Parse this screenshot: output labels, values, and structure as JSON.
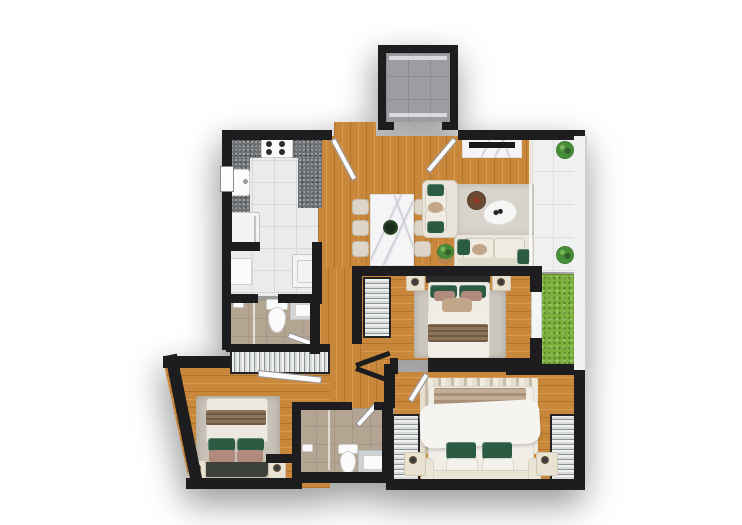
{
  "scene": {
    "title": "apartment-floor-plan",
    "view": "3d-top-down-render",
    "background": "#ffffff"
  },
  "colors": {
    "wall": "#1d1d1f",
    "wood": "#c8873a",
    "woodLight": "#d89b4f",
    "woodDark": "#b0742d",
    "tile": "#e9ebec",
    "tileLine": "#d6d8da",
    "tan": "#b4a593",
    "tanLine": "#a59686",
    "balc": "#eef0f1",
    "balcLine": "#dde0e2",
    "elev": "#9b9da0",
    "elevLine": "#8a8c8f",
    "grass": "#7eb13d",
    "grassDark": "#5f9030",
    "granite": "#6e7173",
    "appl": "#f4f4f5",
    "applEdge": "#c6c6c8",
    "fix": "#fbfbfc",
    "fixEdge": "#cfcfd1",
    "stripeB": "#8e9496",
    "frame": "#242426",
    "sofa": "#eae5da",
    "sofaEdge": "#d2cabb",
    "green": "#2b5c43",
    "tanPillow": "#c2a689",
    "pink": "#b08a7c",
    "throw": "#8d7459",
    "throwLine": "#6f5a43",
    "rugLiving": "#d8d4cc",
    "rugBed3": "#cdc7bf",
    "rugBed2": "#c8c1b7",
    "rugMA": "#e6dfd1",
    "rugMB": "#c8bda9",
    "marble": "#f5f5f7",
    "vein": "#c9cad0",
    "hbDark": "#2b2b2d",
    "hbCream": "#ebe5d8",
    "leaf": "#fcfcfc",
    "leafEdge": "#8a8a8c",
    "outerW": "#f0f1f2",
    "outerWEdge": "#cdd0d2",
    "stool": "#b5864f",
    "brownTable": "#6b4a33",
    "mug": "#8a3b2a"
  },
  "rooms": [
    {
      "name": "elevator"
    },
    {
      "name": "kitchen"
    },
    {
      "name": "laundry"
    },
    {
      "name": "bathroom-1"
    },
    {
      "name": "hall-closet"
    },
    {
      "name": "living-dining"
    },
    {
      "name": "balcony"
    },
    {
      "name": "planter-grass"
    },
    {
      "name": "bedroom-1"
    },
    {
      "name": "hallway"
    },
    {
      "name": "bedroom-2"
    },
    {
      "name": "bathroom-2"
    },
    {
      "name": "master-bedroom"
    }
  ],
  "furniture": {
    "kitchen": [
      "granite-counter",
      "stove-4-burner",
      "sink",
      "refrigerator"
    ],
    "laundry": [
      "utility-sink",
      "washing-machine"
    ],
    "bathroom_1": [
      "toilet",
      "vanity-sink",
      "shower"
    ],
    "living_dining": [
      "dining-table-marble",
      "dining-chairs-x6",
      "loveseat",
      "sofa",
      "area-rug",
      "coffee-table",
      "round-side-table",
      "potted-plant",
      "tv-console"
    ],
    "balcony": [
      "potted-plant",
      "potted-plant"
    ],
    "bedroom_1": [
      "double-bed",
      "nightstand-x2",
      "wardrobe",
      "area-rug"
    ],
    "bedroom_2": [
      "double-bed",
      "nightstand-x2",
      "area-rug"
    ],
    "bathroom_2": [
      "toilet",
      "vanity-sink",
      "shower"
    ],
    "master_bedroom": [
      "double-bed",
      "nightstand-x2",
      "wardrobe-x2",
      "area-rug"
    ]
  }
}
